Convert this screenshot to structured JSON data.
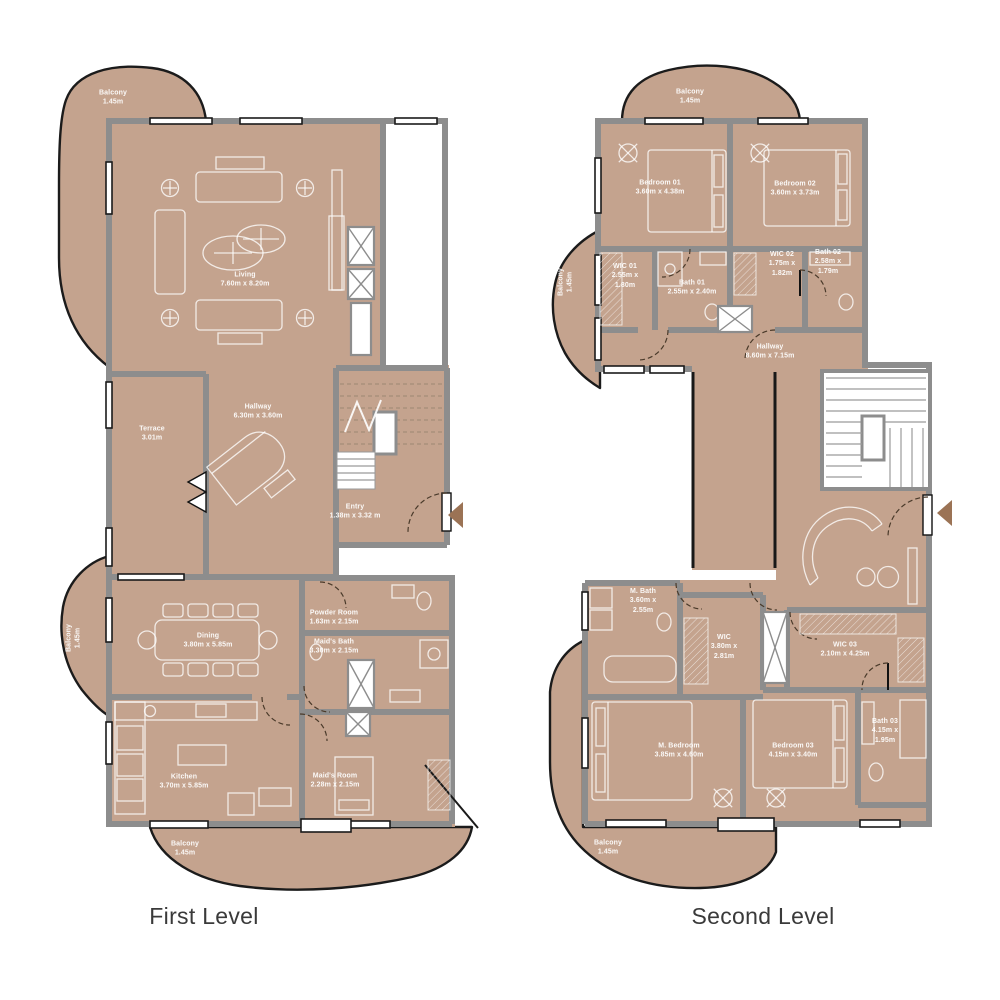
{
  "document": {
    "background": "#ffffff"
  },
  "colors": {
    "floor": "#c4a38e",
    "wall": "#8d8d8d",
    "balcony_outline": "#1b1b1b",
    "label_text": "#f6f1eb",
    "title_text": "#3a3a3a",
    "entry_arrow": "#9b7355"
  },
  "icons": {
    "entry_arrow": "left-triangle",
    "stairs": "stair-treads",
    "elevator_shaft": "crossed-box",
    "ceiling_fan": "circle-cross"
  },
  "plans": [
    {
      "title": "First Level",
      "rooms": [
        {
          "id": "balcony-top",
          "name": "Balcony",
          "dim": "1.45m"
        },
        {
          "id": "living",
          "name": "Living",
          "dim": "7.60m x 8.20m"
        },
        {
          "id": "terrace",
          "name": "Terrace",
          "dim": "3.01m"
        },
        {
          "id": "hallway",
          "name": "Hallway",
          "dim": "6.30m x 3.60m"
        },
        {
          "id": "entry",
          "name": "Entry",
          "dim": "1.38m x 3.32 m"
        },
        {
          "id": "balcony-left",
          "name": "Balcony",
          "dim": "1.45m"
        },
        {
          "id": "dining",
          "name": "Dining",
          "dim": "3.80m x 5.85m"
        },
        {
          "id": "powder-room",
          "name": "Powder Room",
          "dim": "1.63m x 2.15m"
        },
        {
          "id": "maids-bath",
          "name": "Maid's Bath",
          "dim": "3.30m x 2.15m"
        },
        {
          "id": "kitchen",
          "name": "Kitchen",
          "dim": "3.70m x 5.85m"
        },
        {
          "id": "maids-room",
          "name": "Maid's Room",
          "dim": "2.28m x 2.15m"
        },
        {
          "id": "balcony-bottom",
          "name": "Balcony",
          "dim": "1.45m"
        }
      ]
    },
    {
      "title": "Second Level",
      "rooms": [
        {
          "id": "balcony-top",
          "name": "Balcony",
          "dim": "1.45m"
        },
        {
          "id": "bedroom-01",
          "name": "Bedroom 01",
          "dim": "3.60m x 4.38m"
        },
        {
          "id": "bedroom-02",
          "name": "Bedroom 02",
          "dim": "3.60m x 3.73m"
        },
        {
          "id": "balcony-left",
          "name": "Balcony",
          "dim": "1.45m"
        },
        {
          "id": "wic-01",
          "name": "WIC 01",
          "dim": "2.55m x 1.80m"
        },
        {
          "id": "bath-01",
          "name": "Bath 01",
          "dim": "2.55m x 2.40m"
        },
        {
          "id": "wic-02",
          "name": "WIC 02",
          "dim": "1.75m x 1.82m"
        },
        {
          "id": "bath-02",
          "name": "Bath 02",
          "dim": "2.58m x 1.79m"
        },
        {
          "id": "hallway",
          "name": "Hallway",
          "dim": "8.60m x 7.15m"
        },
        {
          "id": "m-bath",
          "name": "M. Bath",
          "dim": "3.60m x 2.55m"
        },
        {
          "id": "wic",
          "name": "WIC",
          "dim": "3.80m x 2.81m"
        },
        {
          "id": "wic-03",
          "name": "WIC 03",
          "dim": "2.10m x 4.25m"
        },
        {
          "id": "bath-03",
          "name": "Bath 03",
          "dim": "4.15m x 1.95m"
        },
        {
          "id": "m-bedroom",
          "name": "M. Bedroom",
          "dim": "3.85m x 4.60m"
        },
        {
          "id": "bedroom-03",
          "name": "Bedroom 03",
          "dim": "4.15m x 3.40m"
        },
        {
          "id": "balcony-bottom",
          "name": "Balcony",
          "dim": "1.45m"
        }
      ]
    }
  ]
}
